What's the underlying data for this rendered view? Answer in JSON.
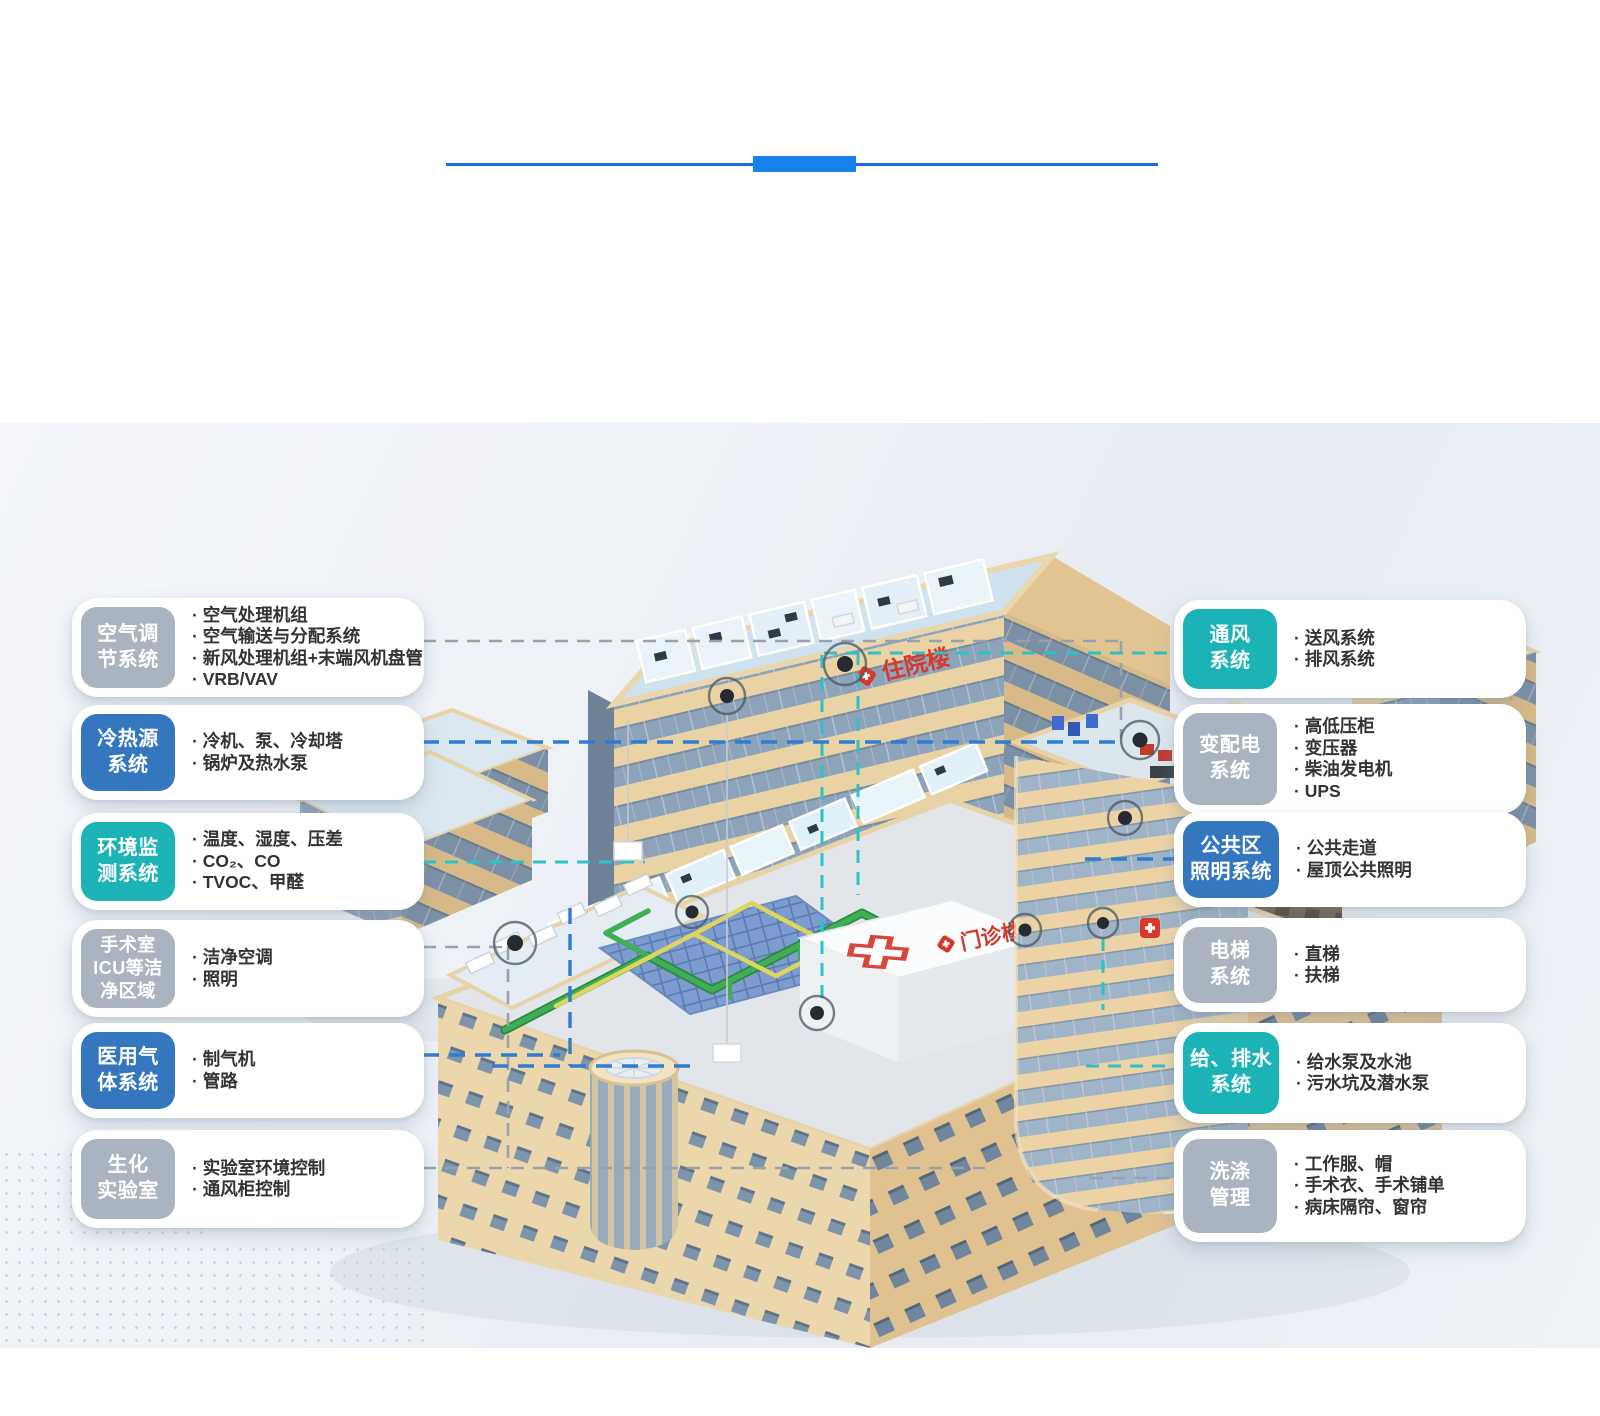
{
  "building": {
    "inpatient_sign": "住院楼",
    "outpatient_sign": "门诊楼"
  },
  "left_cards": [
    {
      "badge_lines": [
        "空气调",
        "节系统"
      ],
      "badge_color": "gray",
      "items": [
        "空气处理机组",
        "空气输送与分配系统",
        "新风处理机组+末端风机盘管",
        "VRB/VAV"
      ]
    },
    {
      "badge_lines": [
        "冷热源",
        "系统"
      ],
      "badge_color": "blue",
      "items": [
        "冷机、泵、冷却塔",
        "锅炉及热水泵"
      ]
    },
    {
      "badge_lines": [
        "环境监",
        "测系统"
      ],
      "badge_color": "teal",
      "items": [
        "温度、湿度、压差",
        "CO₂、CO",
        "TVOC、甲醛"
      ]
    },
    {
      "badge_lines": [
        "手术室",
        "ICU等洁",
        "净区域"
      ],
      "badge_color": "gray",
      "items": [
        "洁净空调",
        "照明"
      ]
    },
    {
      "badge_lines": [
        "医用气",
        "体系统"
      ],
      "badge_color": "blue",
      "items": [
        "制气机",
        "管路"
      ]
    },
    {
      "badge_lines": [
        "生化",
        "实验室"
      ],
      "badge_color": "gray",
      "items": [
        "实验室环境控制",
        "通风柜控制"
      ]
    }
  ],
  "right_cards": [
    {
      "badge_lines": [
        "通风",
        "系统"
      ],
      "badge_color": "teal",
      "items": [
        "送风系统",
        "排风系统"
      ]
    },
    {
      "badge_lines": [
        "变配电",
        "系统"
      ],
      "badge_color": "gray",
      "items": [
        "高低压柜",
        "变压器",
        "柴油发电机",
        "UPS"
      ]
    },
    {
      "badge_lines": [
        "公共区",
        "照明系统"
      ],
      "badge_color": "blue",
      "items": [
        "公共走道",
        "屋顶公共照明"
      ]
    },
    {
      "badge_lines": [
        "电梯",
        "系统"
      ],
      "badge_color": "gray",
      "items": [
        "直梯",
        "扶梯"
      ]
    },
    {
      "badge_lines": [
        "给、排水",
        "系统"
      ],
      "badge_color": "teal",
      "items": [
        "给水泵及水池",
        "污水坑及潜水泵"
      ]
    },
    {
      "badge_lines": [
        "洗涤",
        "管理"
      ],
      "badge_color": "gray",
      "items": [
        "工作服、帽",
        "手术衣、手术铺单",
        "病床隔帘、窗帘"
      ]
    }
  ],
  "colors": {
    "badge_gray": "#a9b4c0",
    "badge_blue": "#3577bf",
    "badge_teal": "#1cb3b6",
    "connector_gray": "#99a2ac",
    "connector_blue": "#2d7dd2",
    "connector_teal": "#2ec1c6",
    "divider_line_blue": "#1b6ce2",
    "divider_accent_blue": "#1583ea",
    "sign_red": "#d6382c"
  }
}
